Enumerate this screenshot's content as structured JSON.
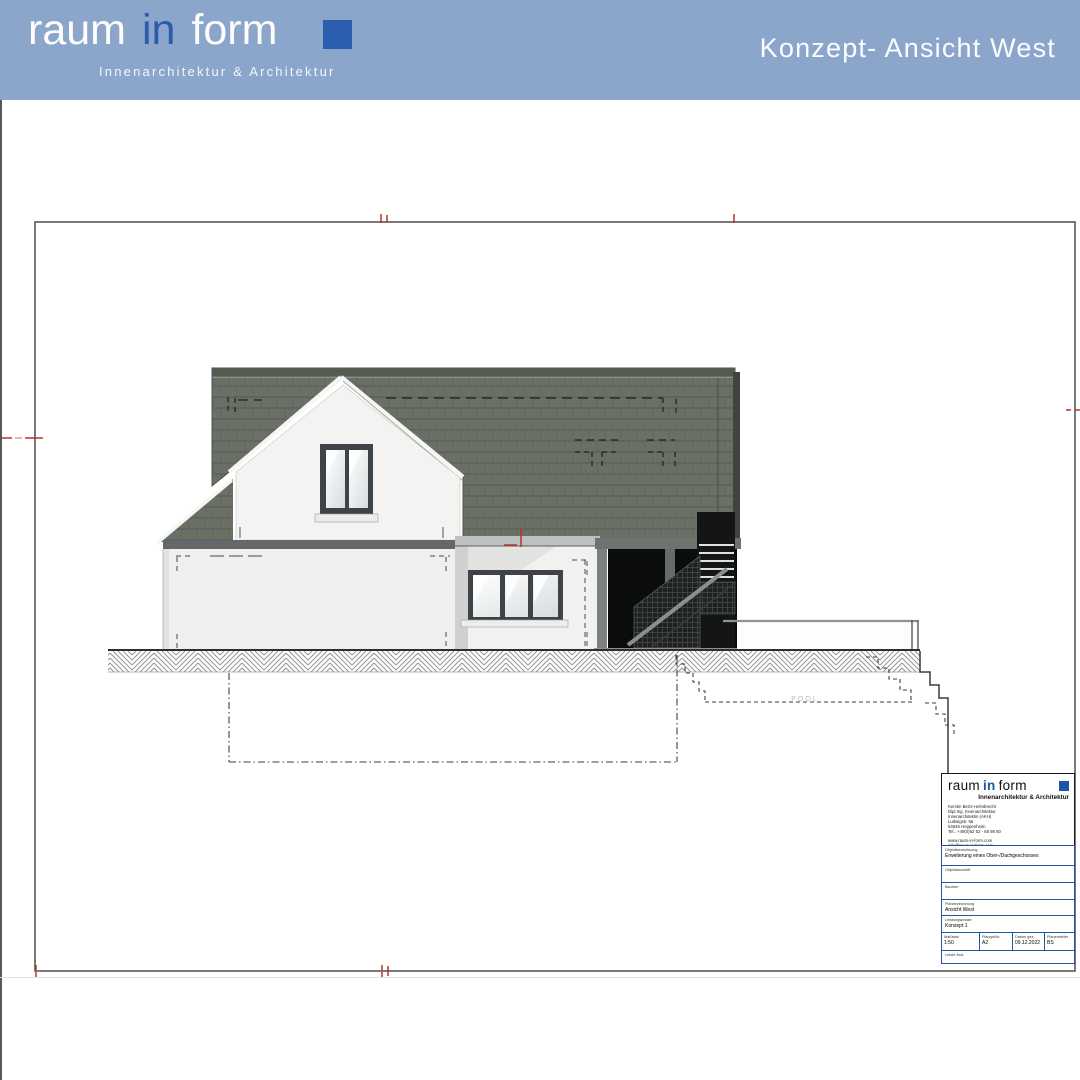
{
  "header": {
    "brand": {
      "word1": "raum",
      "word2": "in",
      "word3": "form",
      "tagline": "Innenarchitektur & Architektur"
    },
    "title": "Konzept- Ansicht West"
  },
  "drawing": {
    "pool_label": "POOL"
  },
  "title_block": {
    "brand": {
      "word1": "raum",
      "word2": "in",
      "word3": "form",
      "tagline": "Innenarchitektur & Architektur"
    },
    "contact_lines": {
      "l1": "Kerstin Bertz-Helmbrecht",
      "l2": "Dipl.Ing. Innenarchitektur",
      "l3": "Innenarchitektin (AKH)",
      "l4": "Ludwigstr. 56",
      "l5": "64646 Heppenheim",
      "l6": "Tel.: +49(0)62 52 - 68 98 80"
    },
    "web_lines": {
      "l1": "www.raum-in-form.com",
      "l2": "info@raum-in-form.com"
    },
    "fields": {
      "objekt_label": "Objektbezeichnung",
      "objekt_value": "Erweiterung eines Ober-/Dachgeschosses",
      "anschrift_label": "Objektanschrift",
      "anschrift_value": "",
      "bauherr_label": "Bauherr",
      "bauherr_value": "",
      "plan_label": "Planbezeichnung",
      "plan_value": "Ansicht West",
      "phase_label": "Leistungsphase",
      "phase_value": "Konzept 1",
      "massstab_label": "Maßstab",
      "massstab_value": "1:50",
      "plangroesse_label": "Plangröße",
      "plangroesse_value": "A2",
      "datum_label": "Datum gez.",
      "datum_value": "09.12.2022",
      "ersteller_label": "Planersteller",
      "ersteller_value": "BS",
      "letzte_label": "Letzte Änd.",
      "letzte_value": ""
    }
  },
  "colors": {
    "header_bg": "#8ca6cb",
    "brand_blue": "#2b5eae",
    "titleblock_blue": "#1e56a8",
    "roof": "#6b7066",
    "wall": "#f1f1f0",
    "carport_dark": "#131615",
    "red_mark": "#b3362c",
    "pool_text": "#b3bcc6"
  }
}
